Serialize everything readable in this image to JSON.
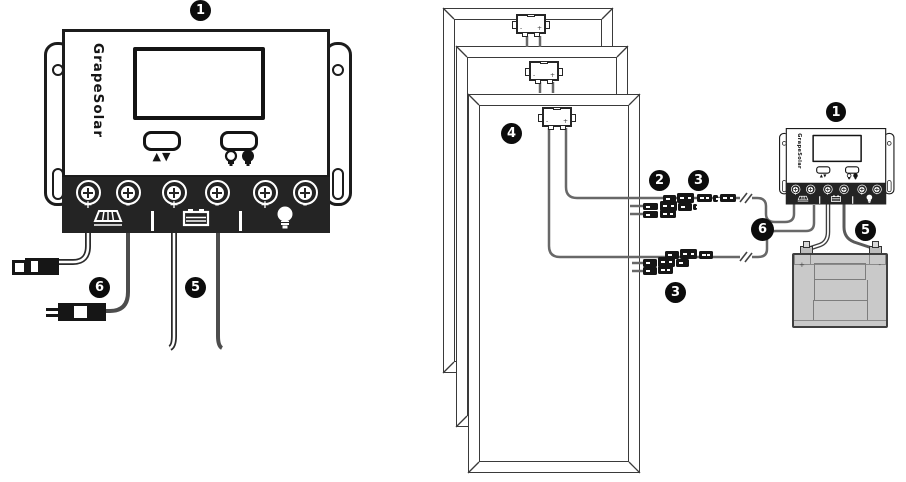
{
  "device": {
    "brand": "GrapeSolar",
    "buttons": {
      "updown_glyph": "▲▼"
    }
  },
  "polarity": {
    "plus": "+",
    "minus": "-"
  },
  "callouts": {
    "c1": "1",
    "c2": "2",
    "c3": "3",
    "c4": "4",
    "c5": "5",
    "c6": "6"
  },
  "icons": {
    "solar_terminal": "solar-panel-icon",
    "battery_terminal": "battery-icon",
    "load_terminal": "light-bulb-icon",
    "button_left": "up-down-arrows",
    "button_right": "lamp-on-off-icons"
  },
  "colors": {
    "line": "#1c1c1c",
    "strip": "#242424",
    "wire_gray": "#686868",
    "battery_fill": "#c9c9c9",
    "callout_bg": "#0c0c0c"
  }
}
